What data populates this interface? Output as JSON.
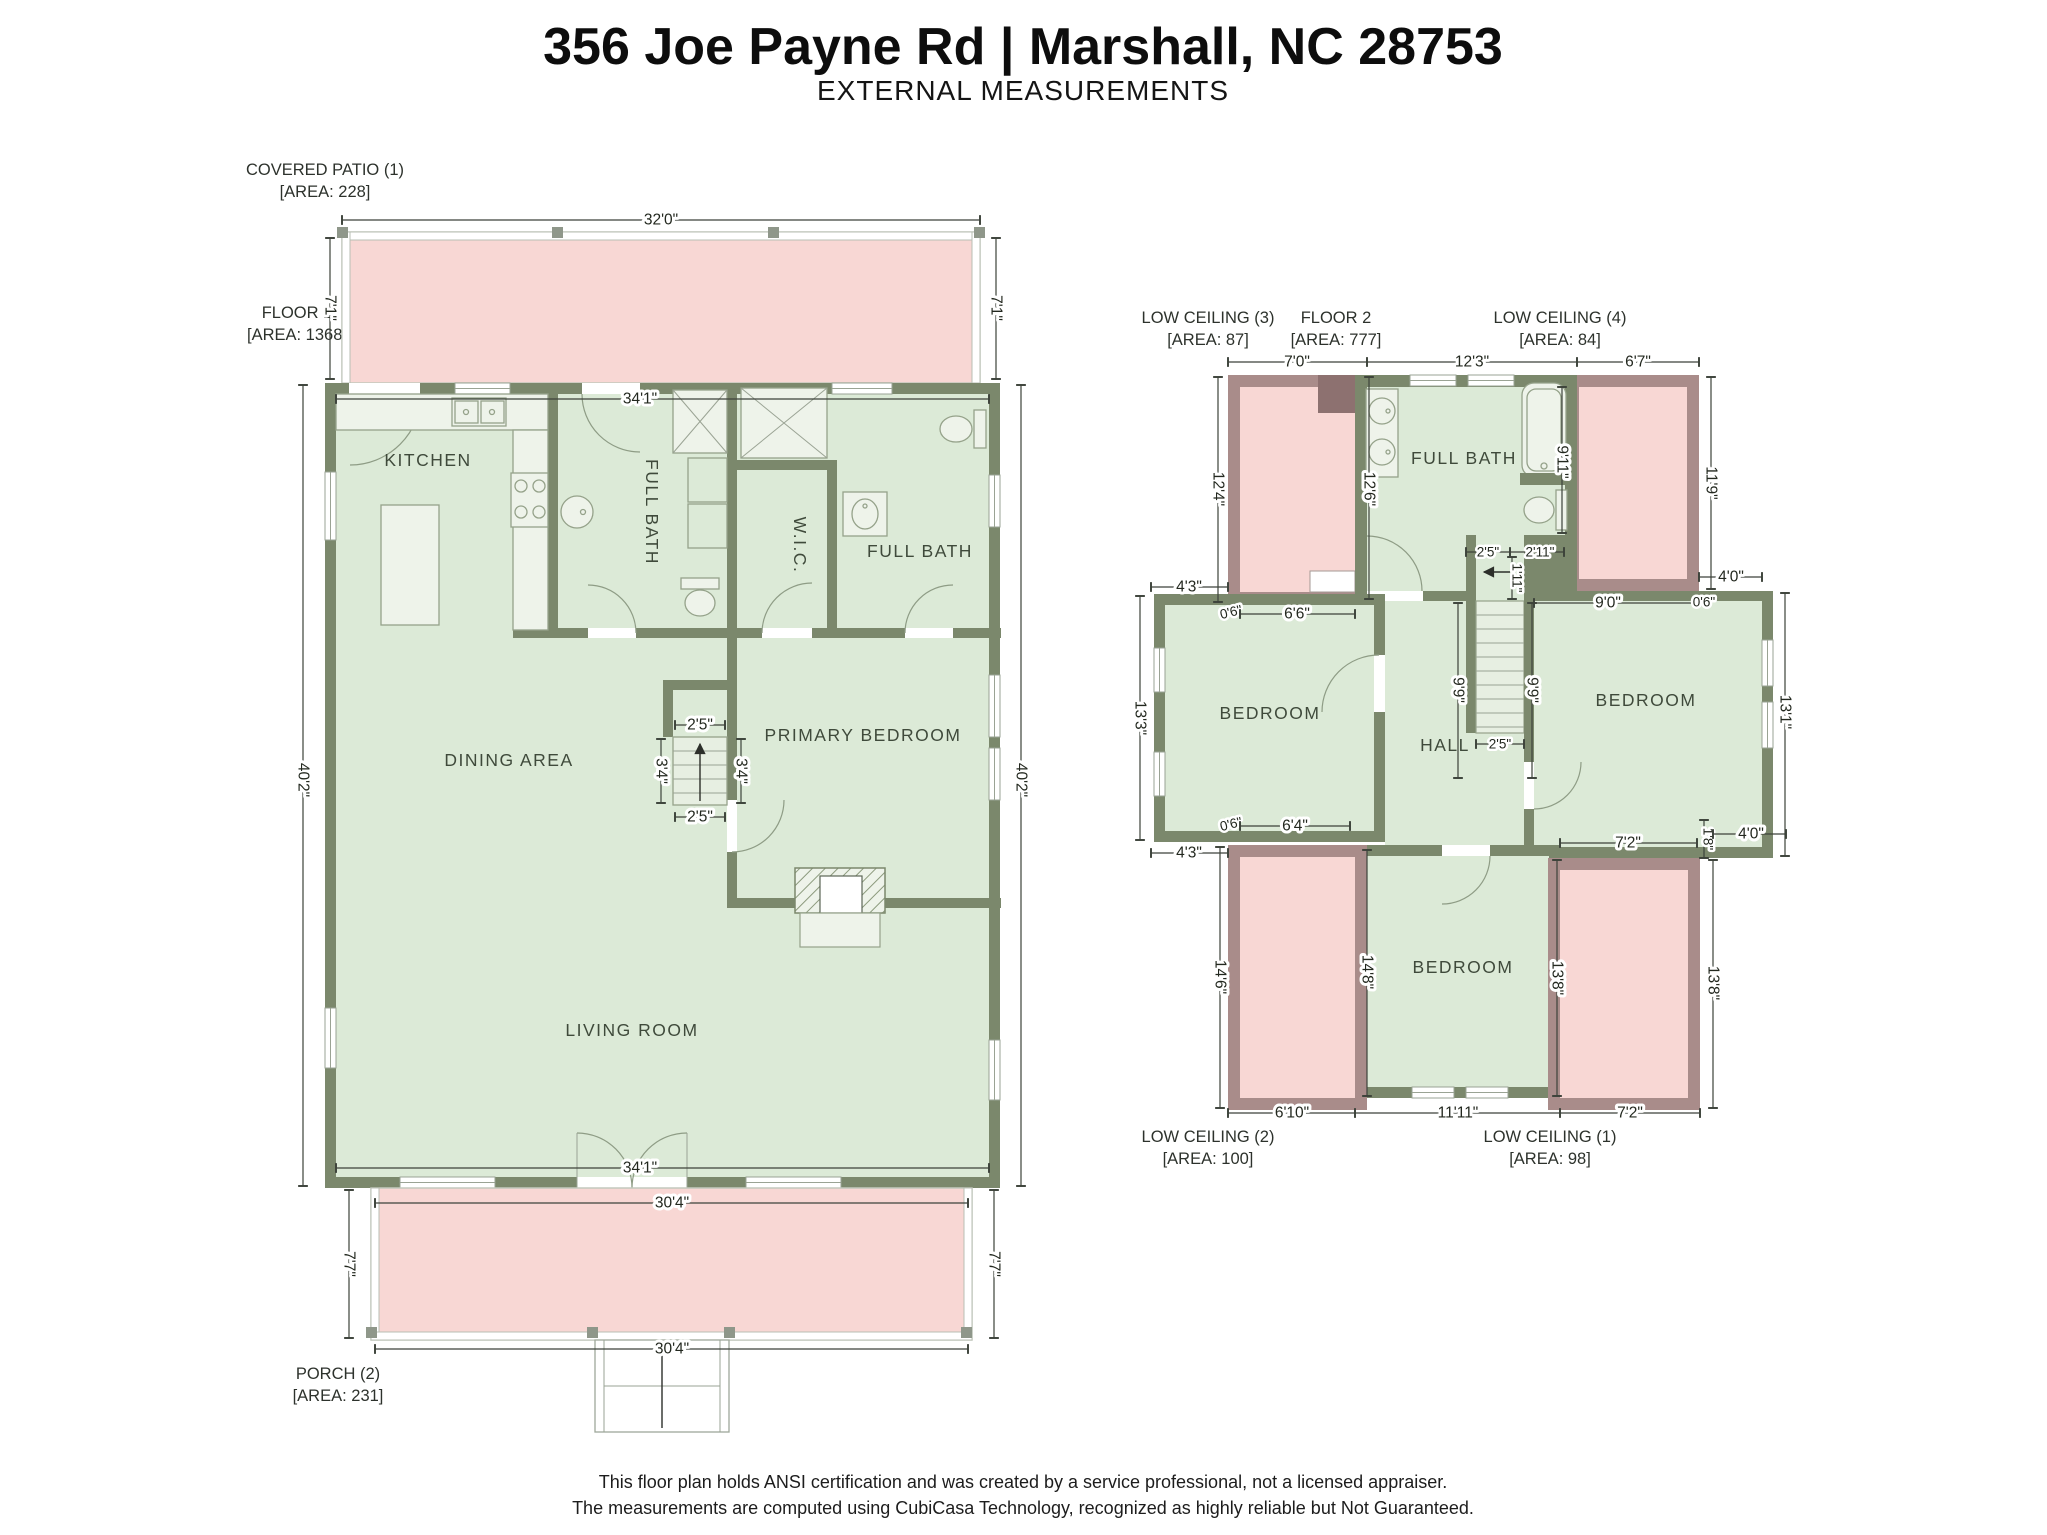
{
  "header": {
    "title": "356 Joe Payne Rd | Marshall, NC 28753",
    "subtitle": "EXTERNAL MEASUREMENTS"
  },
  "colors": {
    "floor_fill": "#dcead7",
    "open_area_fill": "#f8d7d4",
    "wall": "#7b886c",
    "low_ceiling_wall": "#a98c8a",
    "fixture_fill": "#eef3ea",
    "dimension_text": "#23281f",
    "room_text": "#3f4a3b"
  },
  "floor1": {
    "label": "FLOOR 1",
    "area": "[AREA: 1368]",
    "covered_patio": {
      "label": "COVERED PATIO (1)",
      "area": "[AREA: 228]"
    },
    "porch": {
      "label": "PORCH (2)",
      "area": "[AREA: 231]"
    },
    "rooms": {
      "kitchen": "KITCHEN",
      "full_bath_left": "FULL BATH",
      "wic": "W.I.C.",
      "full_bath_primary": "FULL BATH",
      "dining": "DINING AREA",
      "primary_bedroom": "PRIMARY BEDROOM",
      "living": "LIVING ROOM"
    },
    "dims": {
      "d32_0": "32'0\"",
      "d7_1": "7'1\"",
      "d34_1": "34'1\"",
      "d40_2": "40'2\"",
      "d2_5": "2'5\"",
      "d3_4": "3'4\"",
      "d30_4": "30'4\"",
      "d7_7": "7'7\""
    }
  },
  "floor2": {
    "label": "FLOOR 2",
    "area": "[AREA: 777]",
    "low_ceiling_1": {
      "label": "LOW CEILING (1)",
      "area": "[AREA: 98]"
    },
    "low_ceiling_2": {
      "label": "LOW CEILING (2)",
      "area": "[AREA: 100]"
    },
    "low_ceiling_3": {
      "label": "LOW CEILING (3)",
      "area": "[AREA: 87]"
    },
    "low_ceiling_4": {
      "label": "LOW CEILING (4)",
      "area": "[AREA: 84]"
    },
    "rooms": {
      "full_bath": "FULL BATH",
      "bedroom": "BEDROOM",
      "hall": "HALL"
    },
    "dims": {
      "d7_0": "7'0\"",
      "d12_3": "12'3\"",
      "d6_7": "6'7\"",
      "d12_4": "12'4\"",
      "d12_6": "12'6\"",
      "d9_11": "9'11\"",
      "d11_9": "11'9\"",
      "d2_5": "2'5\"",
      "d2_11": "2'11\"",
      "d1_11": "1'11\"",
      "d4_3": "4'3\"",
      "d0_6": "0'6\"",
      "d6_6": "6'6\"",
      "d9_0": "9'0\"",
      "d4_0": "4'0\"",
      "d13_3": "13'3\"",
      "d13_1": "13'1\"",
      "d9_9": "9'9\"",
      "d6_4": "6'4\"",
      "d7_2": "7'2\"",
      "d1_8": "1'8\"",
      "d14_6": "14'6\"",
      "d14_8": "14'8\"",
      "d13_8": "13'8\"",
      "d6_10": "6'10\"",
      "d11_11": "11'11\""
    }
  },
  "footer": {
    "line1": "This floor plan holds ANSI certification and was created by a service professional, not a licensed appraiser.",
    "line2": "The measurements are computed using CubiCasa Technology, recognized as highly reliable but Not Guaranteed."
  }
}
